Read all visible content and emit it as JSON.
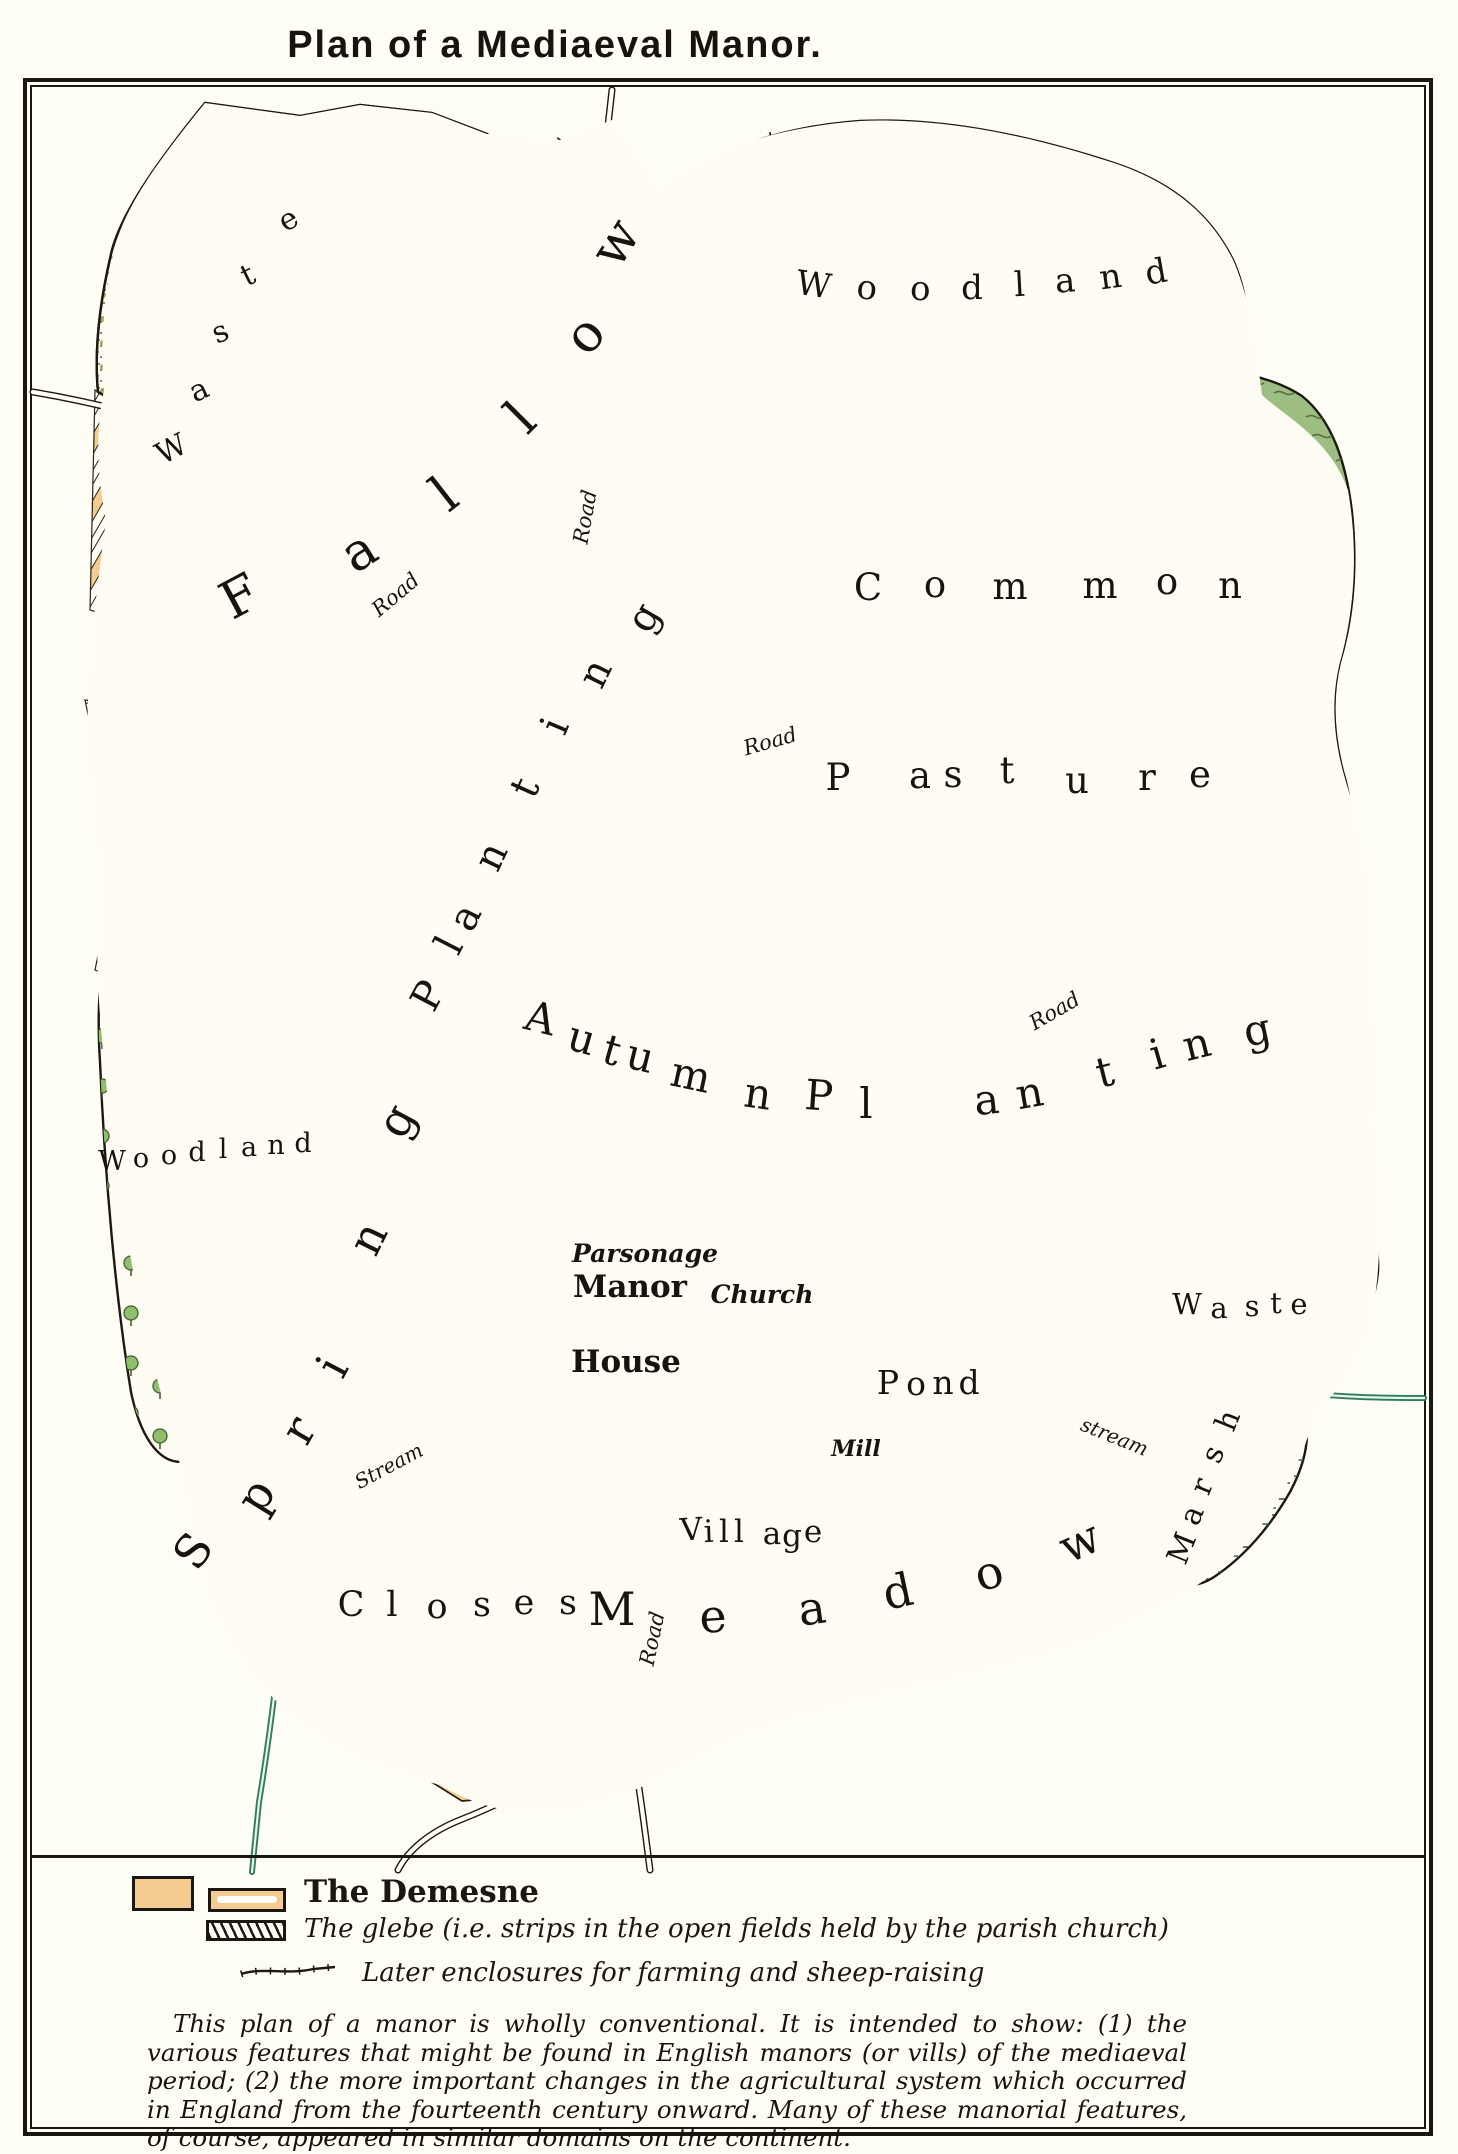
{
  "title": "Plan of a Mediaeval Manor.",
  "colors": {
    "demesne_orange": "#F4CC90",
    "pasture_green": "#9CBE82",
    "meadow_green": "#A9C98E",
    "village_green": "#47835A",
    "pond_grey_blue": "#9FB6BA",
    "stream_green": "#2F7D5B",
    "building_red": "#E0796B",
    "ink": "#1C1812"
  },
  "map": {
    "words": {
      "road": "Road",
      "stream_cap": "Stream",
      "stream": "stream",
      "manor": "Manor",
      "house": "House",
      "parsonage": "Parsonage",
      "church": "Church",
      "mill": "Mill"
    },
    "icons": {
      "church_cross": "✚",
      "mill_star": "✳"
    },
    "labels": {
      "waste_nw": {
        "fs": 30,
        "letters": [
          {
            "t": "W",
            "x": 176,
            "y": 458,
            "r": -28
          },
          {
            "t": "a",
            "x": 203,
            "y": 399,
            "r": -25
          },
          {
            "t": "s",
            "x": 224,
            "y": 341,
            "r": -23
          },
          {
            "t": "t",
            "x": 252,
            "y": 284,
            "r": -26
          },
          {
            "t": "e",
            "x": 293,
            "y": 228,
            "r": -30
          }
        ]
      },
      "fallow": {
        "fs": 52,
        "letters": [
          {
            "t": "F",
            "x": 248,
            "y": 612,
            "r": -28
          },
          {
            "t": "a",
            "x": 368,
            "y": 566,
            "r": -32
          },
          {
            "t": "l",
            "x": 455,
            "y": 508,
            "r": -38
          },
          {
            "t": "l",
            "x": 533,
            "y": 430,
            "r": -45
          },
          {
            "t": "o",
            "x": 598,
            "y": 346,
            "r": -50
          },
          {
            "t": "w",
            "x": 630,
            "y": 252,
            "r": -58
          }
        ]
      },
      "woodland_ne": {
        "fs": 34,
        "letters": [
          {
            "t": "W",
            "x": 812,
            "y": 296,
            "r": 8
          },
          {
            "t": "o",
            "x": 866,
            "y": 299,
            "r": 5
          },
          {
            "t": "o",
            "x": 920,
            "y": 300,
            "r": 2
          },
          {
            "t": "d",
            "x": 972,
            "y": 299,
            "r": 0
          },
          {
            "t": "l",
            "x": 1020,
            "y": 296,
            "r": -3
          },
          {
            "t": "a",
            "x": 1066,
            "y": 292,
            "r": -5
          },
          {
            "t": "n",
            "x": 1112,
            "y": 288,
            "r": -8
          },
          {
            "t": "d",
            "x": 1158,
            "y": 283,
            "r": -10
          }
        ]
      },
      "common": {
        "fs": 37,
        "letters": [
          {
            "t": "C",
            "x": 868,
            "y": 600,
            "r": 0
          },
          {
            "t": "o",
            "x": 935,
            "y": 597,
            "r": 0
          },
          {
            "t": "m",
            "x": 1010,
            "y": 599,
            "r": 0
          },
          {
            "t": "m",
            "x": 1100,
            "y": 598,
            "r": 0
          },
          {
            "t": "o",
            "x": 1167,
            "y": 594,
            "r": 0
          },
          {
            "t": "n",
            "x": 1230,
            "y": 598,
            "r": 0
          }
        ]
      },
      "pasture": {
        "fs": 37,
        "letters": [
          {
            "t": "P",
            "x": 838,
            "y": 790,
            "r": 0
          },
          {
            "t": "a",
            "x": 920,
            "y": 788,
            "r": 0
          },
          {
            "t": "s",
            "x": 953,
            "y": 787,
            "r": 0
          },
          {
            "t": "t",
            "x": 1007,
            "y": 783,
            "r": 0
          },
          {
            "t": "u",
            "x": 1077,
            "y": 793,
            "r": 0
          },
          {
            "t": "r",
            "x": 1147,
            "y": 790,
            "r": 0
          },
          {
            "t": "e",
            "x": 1200,
            "y": 787,
            "r": 0
          }
        ]
      },
      "autumn": {
        "fs": 42,
        "letters": [
          {
            "t": "A",
            "x": 537,
            "y": 1032,
            "r": 14
          },
          {
            "t": "u",
            "x": 578,
            "y": 1052,
            "r": 16
          },
          {
            "t": "t",
            "x": 608,
            "y": 1064,
            "r": 16
          },
          {
            "t": "u",
            "x": 637,
            "y": 1070,
            "r": 14
          },
          {
            "t": "m",
            "x": 688,
            "y": 1089,
            "r": 12
          },
          {
            "t": "n",
            "x": 756,
            "y": 1108,
            "r": 8
          }
        ]
      },
      "planting_mid": {
        "fs": 42,
        "letters": [
          {
            "t": "P",
            "x": 818,
            "y": 1110,
            "r": 4
          },
          {
            "t": "l",
            "x": 866,
            "y": 1118,
            "r": 0
          },
          {
            "t": "a",
            "x": 988,
            "y": 1114,
            "r": -6
          },
          {
            "t": "n",
            "x": 1032,
            "y": 1107,
            "r": -10
          },
          {
            "t": "t",
            "x": 1108,
            "y": 1086,
            "r": -14
          },
          {
            "t": "i",
            "x": 1161,
            "y": 1068,
            "r": -16
          },
          {
            "t": "n",
            "x": 1200,
            "y": 1058,
            "r": -14
          },
          {
            "t": "g",
            "x": 1260,
            "y": 1044,
            "r": -12
          }
        ]
      },
      "planting_left": {
        "fs": 40,
        "letters": [
          {
            "t": "P",
            "x": 440,
            "y": 1002,
            "r": -62
          },
          {
            "t": "l",
            "x": 461,
            "y": 951,
            "r": -63
          },
          {
            "t": "a",
            "x": 477,
            "y": 923,
            "r": -64
          },
          {
            "t": "n",
            "x": 503,
            "y": 862,
            "r": -65
          },
          {
            "t": "t",
            "x": 537,
            "y": 793,
            "r": -66
          },
          {
            "t": "i",
            "x": 567,
            "y": 731,
            "r": -67
          },
          {
            "t": "n",
            "x": 607,
            "y": 679,
            "r": -64
          },
          {
            "t": "g",
            "x": 655,
            "y": 624,
            "r": -60
          }
        ]
      },
      "spring": {
        "fs": 46,
        "letters": [
          {
            "t": "S",
            "x": 206,
            "y": 1560,
            "r": -55
          },
          {
            "t": "p",
            "x": 269,
            "y": 1504,
            "r": -58
          },
          {
            "t": "r",
            "x": 312,
            "y": 1438,
            "r": -60
          },
          {
            "t": "i",
            "x": 346,
            "y": 1374,
            "r": -62
          },
          {
            "t": "n",
            "x": 382,
            "y": 1245,
            "r": -64
          },
          {
            "t": "g",
            "x": 410,
            "y": 1128,
            "r": -62
          }
        ]
      },
      "woodland_w": {
        "fs": 27,
        "letters": [
          {
            "t": "W",
            "x": 112,
            "y": 1170,
            "r": 0
          },
          {
            "t": "o",
            "x": 141,
            "y": 1167,
            "r": 0
          },
          {
            "t": "o",
            "x": 169,
            "y": 1164,
            "r": 0
          },
          {
            "t": "d",
            "x": 197,
            "y": 1161,
            "r": 0
          },
          {
            "t": "l",
            "x": 223,
            "y": 1158,
            "r": 0
          },
          {
            "t": "a",
            "x": 249,
            "y": 1156,
            "r": 0
          },
          {
            "t": "n",
            "x": 276,
            "y": 1154,
            "r": 0
          },
          {
            "t": "d",
            "x": 303,
            "y": 1152,
            "r": 0
          }
        ]
      },
      "waste_e": {
        "fs": 29,
        "letters": [
          {
            "t": "W",
            "x": 1187,
            "y": 1314,
            "r": 0
          },
          {
            "t": "a",
            "x": 1219,
            "y": 1318,
            "r": 0
          },
          {
            "t": "s",
            "x": 1252,
            "y": 1316,
            "r": 0
          },
          {
            "t": "t",
            "x": 1276,
            "y": 1313,
            "r": 0
          },
          {
            "t": "e",
            "x": 1299,
            "y": 1314,
            "r": 0
          }
        ]
      },
      "marsh": {
        "fs": 30,
        "letters": [
          {
            "t": "M",
            "x": 1191,
            "y": 1552,
            "r": -68
          },
          {
            "t": "a",
            "x": 1201,
            "y": 1519,
            "r": -68
          },
          {
            "t": "r",
            "x": 1211,
            "y": 1490,
            "r": -68
          },
          {
            "t": "s",
            "x": 1222,
            "y": 1458,
            "r": -68
          },
          {
            "t": "h",
            "x": 1237,
            "y": 1424,
            "r": -68
          }
        ]
      },
      "closes": {
        "fs": 35,
        "letters": [
          {
            "t": "C",
            "x": 351,
            "y": 1616,
            "r": 0
          },
          {
            "t": "l",
            "x": 392,
            "y": 1616,
            "r": 0
          },
          {
            "t": "o",
            "x": 437,
            "y": 1618,
            "r": 0
          },
          {
            "t": "s",
            "x": 482,
            "y": 1616,
            "r": 0
          },
          {
            "t": "e",
            "x": 524,
            "y": 1614,
            "r": 0
          },
          {
            "t": "s",
            "x": 568,
            "y": 1614,
            "r": 0
          }
        ]
      },
      "meadow": {
        "fs": 46,
        "letters": [
          {
            "t": "M",
            "x": 612,
            "y": 1625,
            "r": 0
          },
          {
            "t": "e",
            "x": 714,
            "y": 1632,
            "r": -4
          },
          {
            "t": "a",
            "x": 814,
            "y": 1624,
            "r": -8
          },
          {
            "t": "d",
            "x": 901,
            "y": 1607,
            "r": -12
          },
          {
            "t": "o",
            "x": 993,
            "y": 1588,
            "r": -16
          },
          {
            "t": "w",
            "x": 1086,
            "y": 1556,
            "r": -24
          }
        ]
      },
      "pond": {
        "fs": 33,
        "letters": [
          {
            "t": "P",
            "x": 888,
            "y": 1394,
            "r": 0
          },
          {
            "t": "o",
            "x": 916,
            "y": 1395,
            "r": 0
          },
          {
            "t": "n",
            "x": 943,
            "y": 1394,
            "r": 0
          },
          {
            "t": "d",
            "x": 969,
            "y": 1394,
            "r": 0
          }
        ]
      },
      "village": {
        "fs": 31,
        "letters": [
          {
            "t": "V",
            "x": 692,
            "y": 1540,
            "r": -4
          },
          {
            "t": "i",
            "x": 709,
            "y": 1542,
            "r": -2
          },
          {
            "t": "l",
            "x": 724,
            "y": 1542,
            "r": 0
          },
          {
            "t": "l",
            "x": 739,
            "y": 1542,
            "r": 0
          },
          {
            "t": "a",
            "x": 772,
            "y": 1544,
            "r": 0
          },
          {
            "t": "g",
            "x": 792,
            "y": 1546,
            "r": 0
          },
          {
            "t": "e",
            "x": 813,
            "y": 1542,
            "r": 0
          }
        ]
      }
    }
  },
  "legend": {
    "items": [
      {
        "label": "The Demesne"
      },
      {
        "label": "The glebe (i.e. strips in the open fields held by the parish church)"
      },
      {
        "label": "Later enclosures for farming and sheep-raising"
      }
    ]
  },
  "note": "This plan of a manor is wholly conventional.  It is intended to show:  (1) the various features that might be found in English manors (or vills) of the mediaeval period;  (2) the more important changes in the agricultural system which occurred in England from the fourteenth century onward. Many of these manorial features, of course, appeared in similar domains on the continent."
}
